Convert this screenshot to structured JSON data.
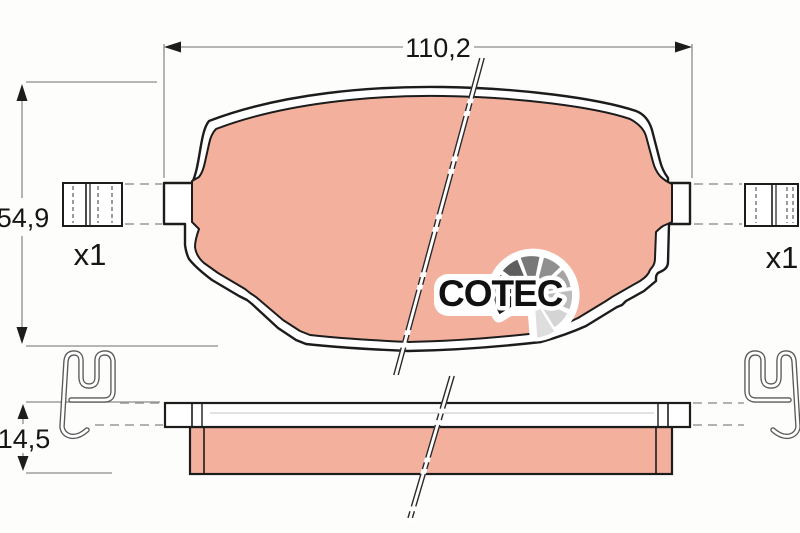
{
  "drawing": {
    "type": "brake-pad technical drawing",
    "dimensions": {
      "width": "110,2",
      "height": "54,9",
      "thickness": "14,5"
    },
    "quantities": {
      "left": "x1",
      "right": "x1"
    },
    "logo": {
      "brand": "COTEC"
    },
    "colors": {
      "background": "#fdfdfb",
      "pad_fill": "#f3b19d",
      "outline": "#1c1c1c",
      "dim_line": "#8c8c8c",
      "fan_shades": [
        "#161616",
        "#3c3c3c",
        "#5e5e5e",
        "#787878",
        "#8f8f8f",
        "#a5a5a5",
        "#bcbcbc",
        "#d4d4d4",
        "#dedede"
      ]
    }
  }
}
